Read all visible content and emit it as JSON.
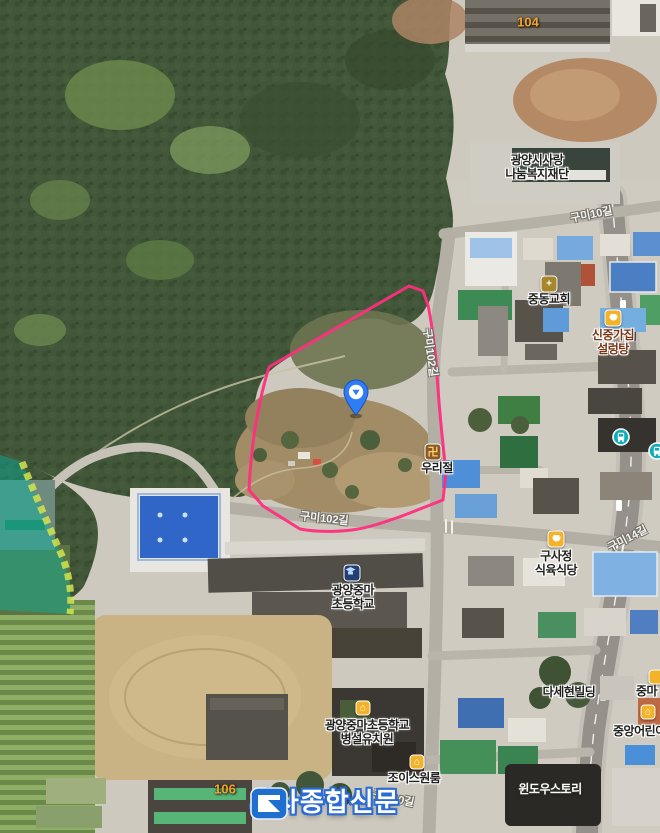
{
  "map": {
    "labels": {
      "welfare": "광양시사랑\n나눔복지재단",
      "church": "중동교회",
      "seolleongtang": "신중가집\n설렁탕",
      "temple": "우리절",
      "butcher": "구사정\n식육식당",
      "elementary": "광양중마\n초등학교",
      "kindergarten": "광양중마초등학교\n병설유치원",
      "building_dasehyun": "다세현빌딩",
      "jungma_partial": "중마",
      "daycare": "중앙어린이집",
      "joys_oneroom": "조이스원룸",
      "window_story": "윈도우스토리",
      "apt_104": "104",
      "apt_106": "106"
    },
    "road_labels": {
      "gumi10_top": "구미10길",
      "gumi102_vertical": "구미102길",
      "gumi102_mid": "구미102길",
      "gumi14_right": "구미14길",
      "gumi10_bottom": "구미10길"
    },
    "icons": {
      "church_glyph": "+",
      "temple_glyph": "卍",
      "home_glyph": "⌂"
    },
    "watermark": {
      "name": "시사종합신문"
    },
    "colors": {
      "site_boundary": "#ff2e7e",
      "marker_blue": "#2e7cf6",
      "bus_teal": "#12adbb",
      "logo_blue": "#1f6fd0",
      "apt_number_orange": "#f2a42d"
    }
  }
}
